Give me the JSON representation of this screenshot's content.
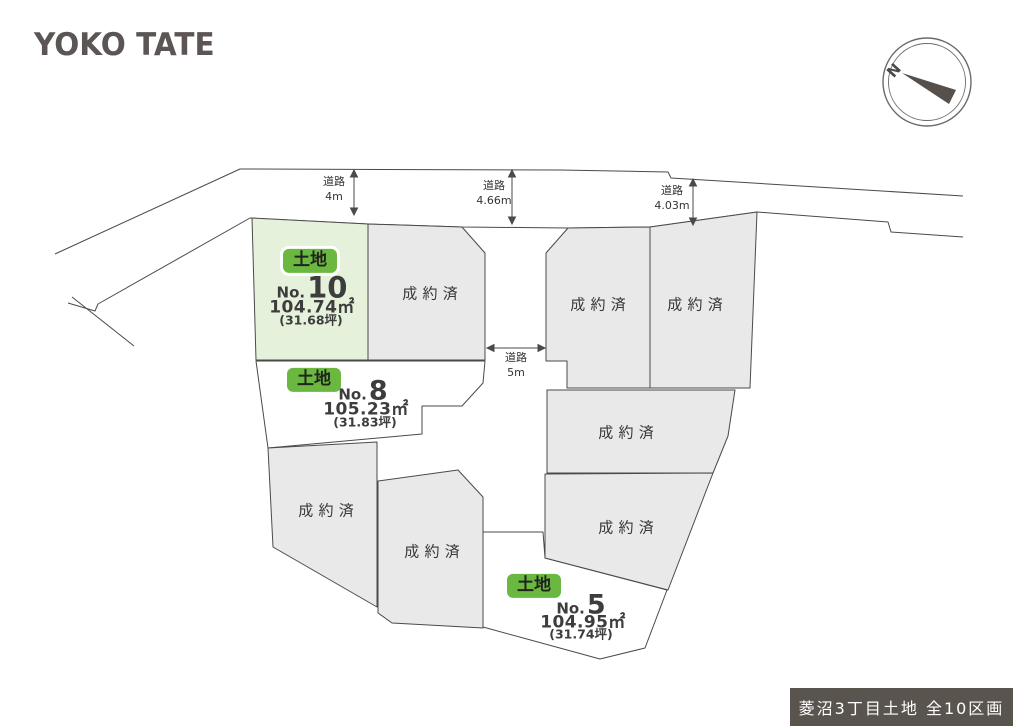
{
  "brand": {
    "logo_text": "YOKO TATE"
  },
  "compass": {
    "north_label": "N"
  },
  "roads": {
    "label": "道路",
    "top_left_width": "4m",
    "top_center_width": "4.66m",
    "top_right_width": "4.03m",
    "center_width": "5m"
  },
  "lots": {
    "available_badge_label": "土地",
    "sold_label": "成約済",
    "sold_count": 7,
    "available": [
      {
        "id": "No.10",
        "no_prefix": "No.",
        "number": "10",
        "area_sqm": "104.74㎡",
        "area_tsubo": "(31.68坪)"
      },
      {
        "id": "No.8",
        "no_prefix": "No.",
        "number": "8",
        "area_sqm": "105.23㎡",
        "area_tsubo": "(31.83坪)"
      },
      {
        "id": "No.5",
        "no_prefix": "No.",
        "number": "5",
        "area_sqm": "104.95㎡",
        "area_tsubo": "(31.74坪)"
      }
    ]
  },
  "footer": {
    "title": "菱沼3丁目土地 全10区画"
  },
  "colors": {
    "available_lot_fill": "#e5f1db",
    "badge_green": "#6ab83f",
    "sold_lot_fill": "#e9e9e9",
    "boundary_line": "#4a4a4a",
    "footer_bg": "#5a544f",
    "logo": "#5c5555"
  }
}
